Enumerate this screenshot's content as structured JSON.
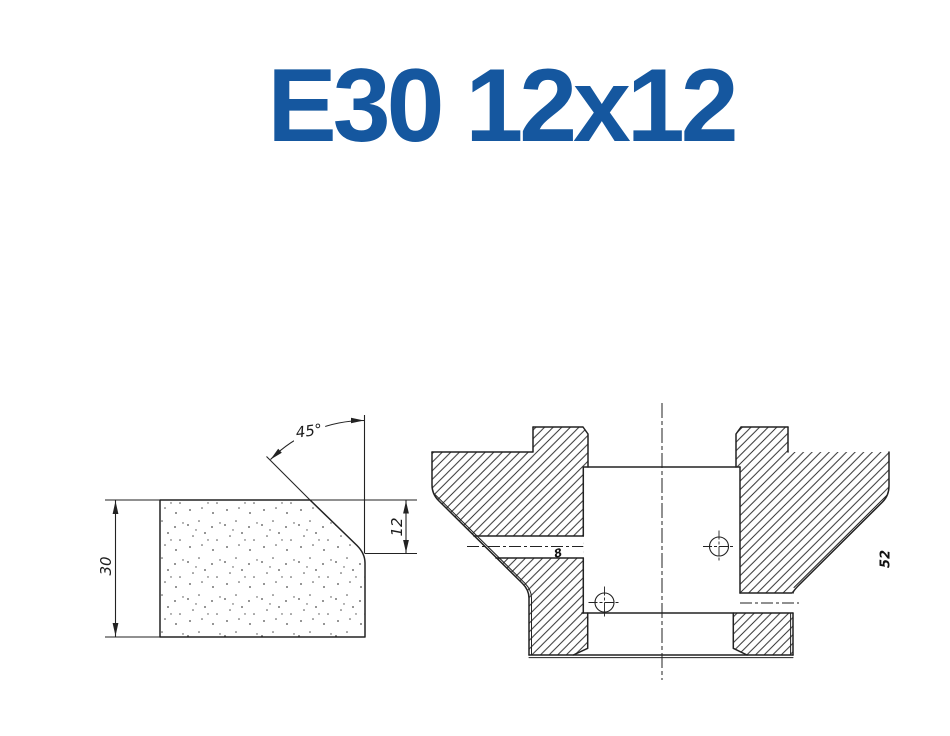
{
  "title": {
    "text": "E30 12x12",
    "color": "#15579f"
  },
  "profile_view": {
    "height_dim": "30",
    "chamfer_height_dim": "12",
    "chamfer_angle": "45°"
  },
  "section_view": {
    "hole_diameter": "8",
    "edge_dim": "52"
  }
}
